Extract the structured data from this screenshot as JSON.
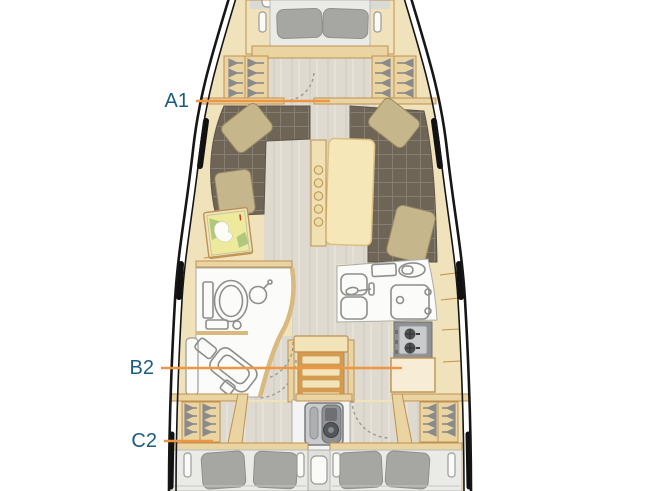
{
  "floorplan": {
    "cabin_labels": [
      {
        "id": "A1"
      },
      {
        "id": "B2"
      },
      {
        "id": "C2"
      }
    ],
    "colors": {
      "label_text": "#1B5C80",
      "leader_line": "#EF9642",
      "hull_line": "#161616",
      "wood": "#F0E2BA",
      "wood_trim": "#BE9150",
      "wall": "#E9D4A2",
      "floor": "#DEDAD0",
      "sofa": "#6F6557",
      "salon_pillow": "#C6B68C",
      "cabin_pillow": "#A6A7A3",
      "mattress": "#EAEAE6",
      "fixture_white": "#FBFBF9",
      "fixture_outline": "#8E8E8B",
      "appliance": "#C9CBCD",
      "stove": "#8F9194",
      "map_yellow": "#EDEA9E",
      "map_green": "#AFC87E"
    }
  }
}
